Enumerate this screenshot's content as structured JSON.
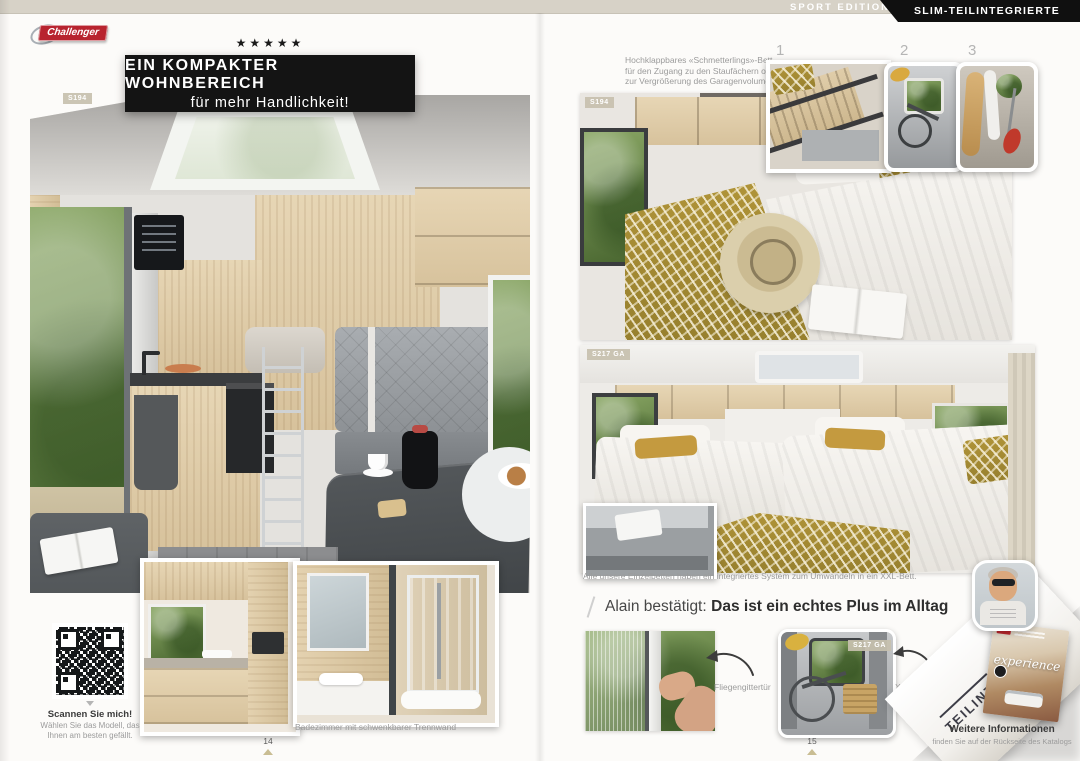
{
  "header": {
    "brand": "Challenger",
    "edition": "SPORT EDITION",
    "category": "SLIM-TEILINTEGRIERTE"
  },
  "left_page": {
    "rating_stars": "★★★★★",
    "headline": "EIN KOMPAKTER WOHNBEREICH",
    "subheadline": "für mehr Handlichkeit!",
    "photo_badge": "S194",
    "bathroom_caption": "Badezimmer mit schwenkbarer Trennwand",
    "qr_title": "Scannen Sie mich!",
    "qr_text": "Wählen Sie das Modell, das Ihnen am besten gefällt.",
    "page_number": "14"
  },
  "right_page": {
    "intro_text": "Hochklappbares «Schmetterlings»-Bett für den Zugang zu den Staufächern oder zur Vergrößerung des Garagenvolumens",
    "thumbs": [
      {
        "number": "1"
      },
      {
        "number": "2"
      },
      {
        "number": "3"
      }
    ],
    "bed_photo_badge": "S194",
    "twin_photo_badge": "S217 GA",
    "beds_caption": "Alle unsere Einzelbetten haben ein integriertes System zum Umwandeln in ein XXL-Bett.",
    "quote_name": "Alain bestätigt:",
    "quote_text": "Das ist ein echtes Plus im Alltag",
    "feature_flyscreen": "Fliegengittertür",
    "feature_garage": "XL Garage",
    "garage_badge": "S217 GA",
    "corner_label": "TEILINTEGRIERTE",
    "cover_script": "experience",
    "info_title": "Weitere Informationen",
    "info_subtitle": "finden Sie auf der Rückseite des Katalogs",
    "page_number": "15"
  },
  "colors": {
    "brand_red": "#b8242f",
    "accent_gold": "#a68a33",
    "header_beige": "#d7d2c7",
    "ink": "#141414",
    "muted_text": "#9b9b9b"
  }
}
